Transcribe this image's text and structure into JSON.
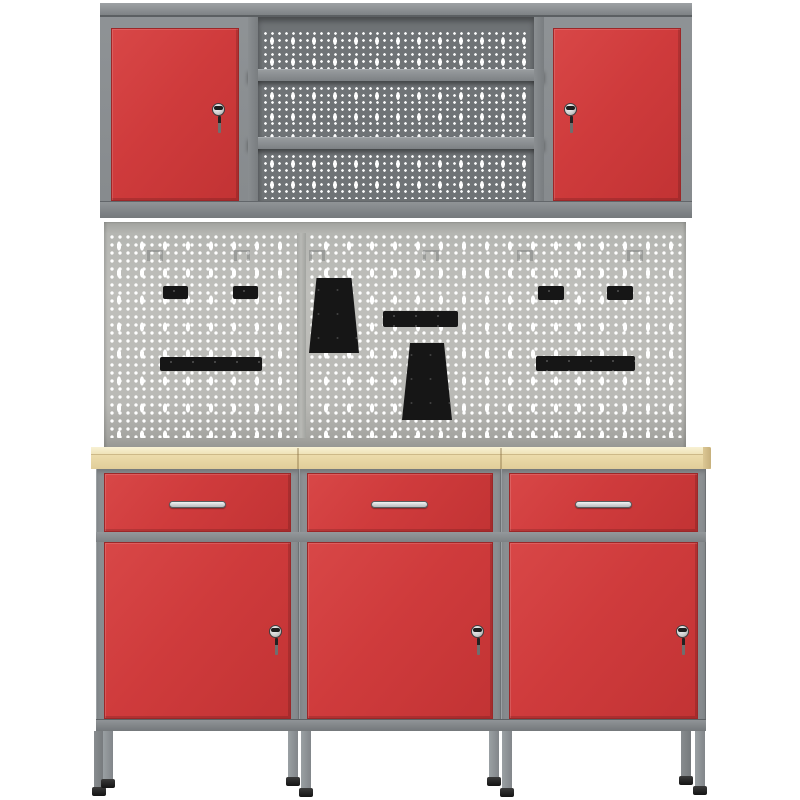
{
  "product": {
    "name": "Workshop storage system: wall cabinet with two locking red doors, perforated tool wall with black tool holders, and three-module workbench with wooden worktop, red drawers and locking red doors"
  },
  "colors": {
    "background": "#ffffff",
    "frame_gray": "#888c8f",
    "dark_perforated_panel": "#6f7376",
    "pegboard_gray": "#b9b9b5",
    "hole_white": "#ffffff",
    "front_red": "#cf3b3c",
    "worktop_tan": "#ebdcab",
    "tool_holder_black": "#161616",
    "foot_black": "#1a1a1a",
    "lock_silver": "#d9d9d9"
  },
  "wall_cabinet": {
    "left_door": {
      "color": "#cf3b3c",
      "has_lock": true,
      "key_hanging": true
    },
    "right_door": {
      "color": "#cf3b3c",
      "has_lock": true,
      "key_hanging": true
    },
    "open_section": {
      "shelf_count": 2,
      "perforated_panel_count": 3
    }
  },
  "pegboard": {
    "seam_x": 299,
    "hangers_x": [
      43,
      130,
      205,
      319,
      413,
      523
    ],
    "items": [
      {
        "name": "tool-holder-small-1",
        "type": "rect",
        "x": 59,
        "y": 64,
        "w": 25,
        "h": 13
      },
      {
        "name": "tool-holder-small-2",
        "type": "rect",
        "x": 129,
        "y": 64,
        "w": 25,
        "h": 13
      },
      {
        "name": "tool-holder-taper-1",
        "type": "trapezoid",
        "x": 205,
        "y": 56,
        "w": 50,
        "h": 75,
        "top_w": 35
      },
      {
        "name": "tool-holder-bar-1",
        "type": "bar",
        "x": 56,
        "y": 135,
        "w": 102,
        "h": 14
      },
      {
        "name": "tool-holder-bar-2",
        "type": "bar",
        "x": 279,
        "y": 89,
        "w": 75,
        "h": 16
      },
      {
        "name": "tool-holder-taper-2",
        "type": "trapezoid",
        "x": 298,
        "y": 121,
        "w": 50,
        "h": 77,
        "top_w": 34
      },
      {
        "name": "tool-holder-small-3",
        "type": "rect",
        "x": 434,
        "y": 64,
        "w": 26,
        "h": 14
      },
      {
        "name": "tool-holder-small-4",
        "type": "rect",
        "x": 503,
        "y": 64,
        "w": 26,
        "h": 14
      },
      {
        "name": "tool-holder-bar-3",
        "type": "bar",
        "x": 432,
        "y": 134,
        "w": 99,
        "h": 15
      }
    ]
  },
  "worktop": {
    "segments": 3,
    "seam_xs": [
      206,
      409
    ]
  },
  "workbench": {
    "modules": [
      {
        "name": "module-1",
        "x": 96,
        "w": 203,
        "drawer_handle": true,
        "door_lock": true
      },
      {
        "name": "module-2",
        "x": 299,
        "w": 202,
        "drawer_handle": true,
        "door_lock": true
      },
      {
        "name": "module-3",
        "x": 501,
        "w": 205,
        "drawer_handle": true,
        "door_lock": true
      }
    ],
    "legs": [
      {
        "x": 94,
        "foot_top": 787,
        "rear": true
      },
      {
        "x": 103,
        "foot_top": 779,
        "rear": false
      },
      {
        "x": 288,
        "foot_top": 777,
        "rear": false
      },
      {
        "x": 301,
        "foot_top": 788,
        "rear": false
      },
      {
        "x": 489,
        "foot_top": 777,
        "rear": false
      },
      {
        "x": 502,
        "foot_top": 788,
        "rear": false
      },
      {
        "x": 681,
        "foot_top": 776,
        "rear": true
      },
      {
        "x": 695,
        "foot_top": 786,
        "rear": false
      }
    ]
  }
}
